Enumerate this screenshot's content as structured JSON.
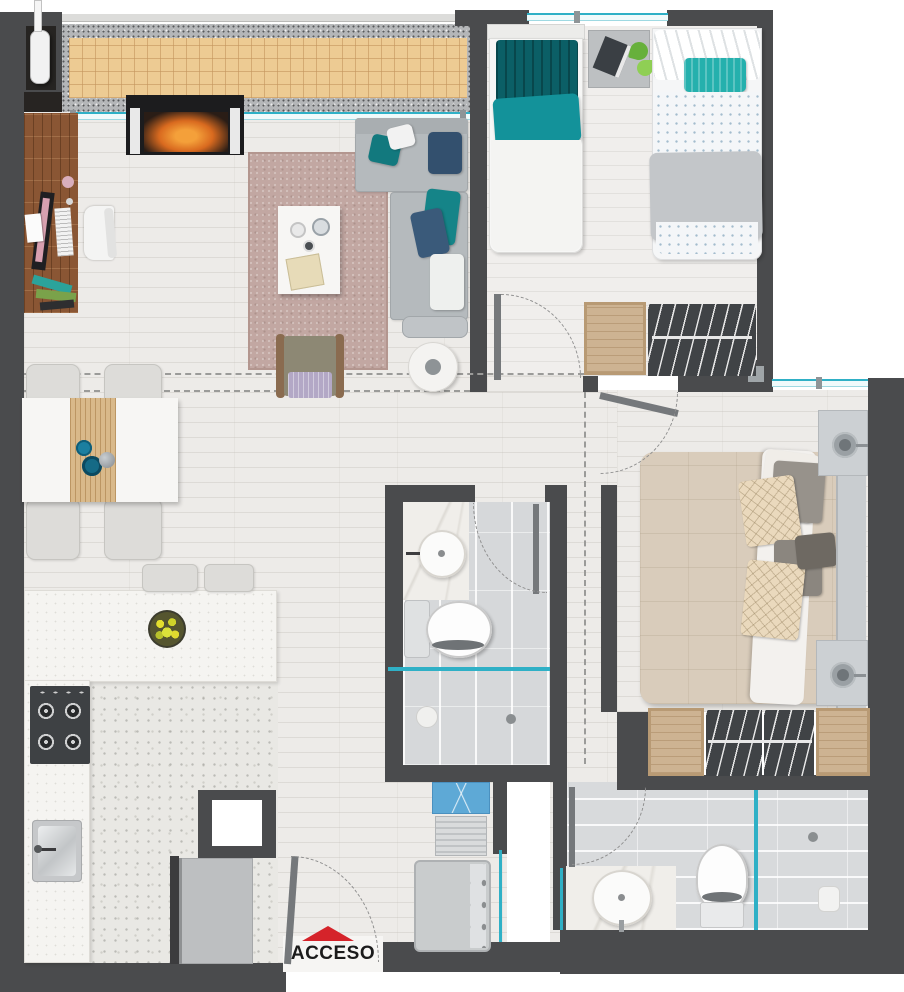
{
  "plan": {
    "access_label": "ACCESO"
  },
  "palette": {
    "wall": "#4a4b4d",
    "wall_dark": "#262422",
    "glass": "#2fb0c6",
    "accent_red": "#d5232a",
    "terrace_tile": "#edcb93",
    "terrace_border": "#b4b6b8",
    "rug": "#c2a7a2",
    "floor_wood": "#edebe8",
    "bath_tile": "#d6d8da",
    "sofa_gray": "#b5babd",
    "textile_teal": "#13929a",
    "textile_navy": "#33506e",
    "bed_beige": "#d9ccbb",
    "label_text": "#1b1b1b"
  }
}
